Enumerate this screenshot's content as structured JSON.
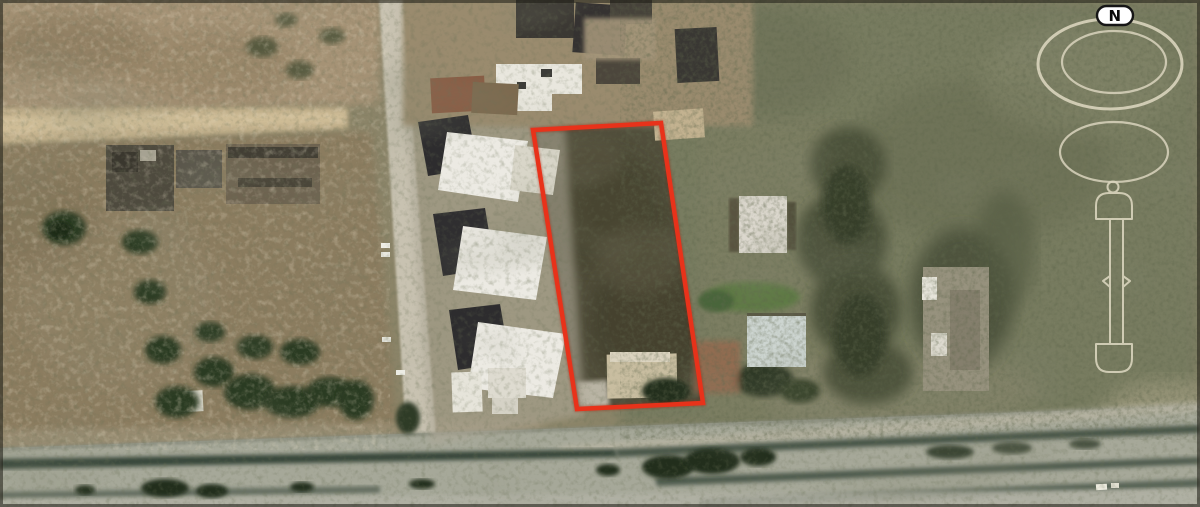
{
  "image": {
    "kind": "satellite aerial photo of land parcel",
    "compass": {
      "north_label": "N",
      "badge_fill": "#ffffff",
      "badge_text_color": "#0c0c0c",
      "ring_color": "#d9d4bd"
    },
    "plot_boundary": {
      "color": "#e8321a",
      "points": "533,130 661,123 703,403 577,409",
      "stroke_width": "4.5"
    },
    "palette": {
      "field_tan": "#a59274",
      "scrub_olive": "#787c60",
      "street_gray": "#c8c2b1",
      "dirt_road_sand": "#c3b18c",
      "highway_gray": "#a6a899",
      "roof_white": "#e9e7de",
      "roof_dark": "#2d2c2e",
      "vegetation_dark": "#2c3a24",
      "plot_interior": "#514e3b"
    }
  }
}
